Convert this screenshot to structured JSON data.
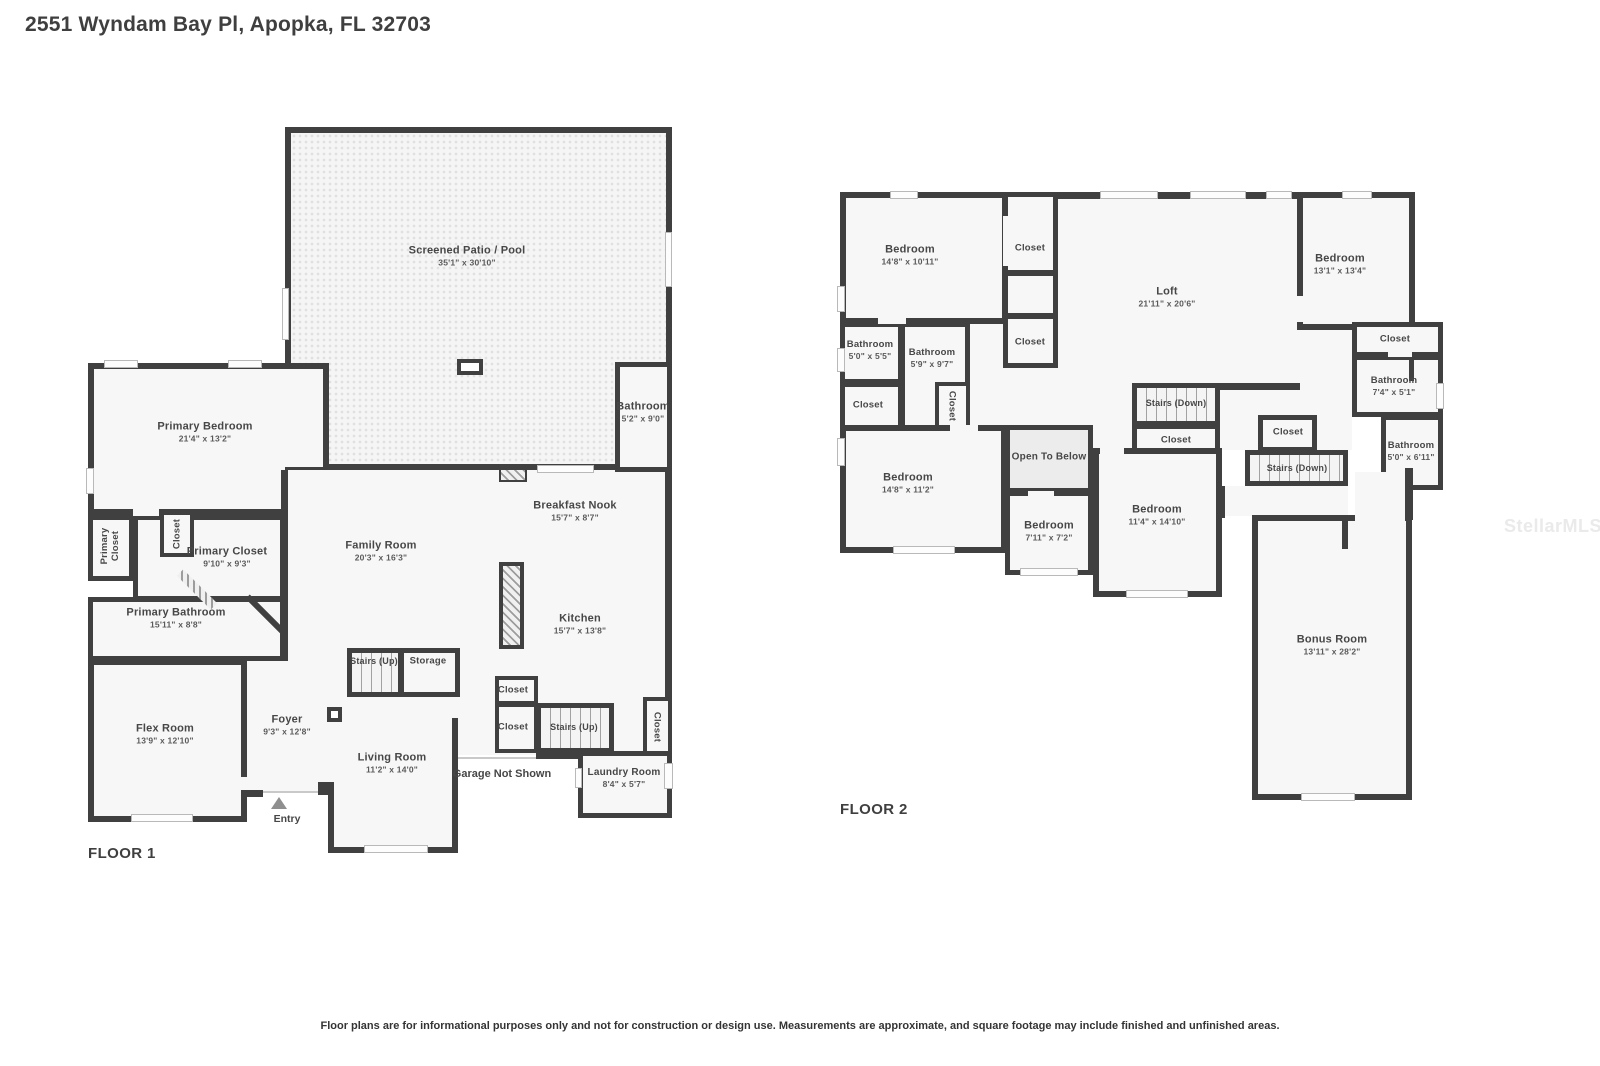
{
  "title": "2551 Wyndam Bay Pl, Apopka, FL 32703",
  "watermark": "StellarMLS",
  "footer": "Floor plans are for informational purposes only and not for construction or design use. Measurements are approximate, and square footage may include finished and unfinished areas.",
  "floor1": {
    "label": "FLOOR 1",
    "entry": "Entry",
    "garage_note": "Garage Not Shown",
    "rooms": {
      "patio": {
        "name": "Screened Patio / Pool",
        "dims": "35'1\" x 30'10\""
      },
      "bathroom": {
        "name": "Bathroom",
        "dims": "5'2\" x 9'0\""
      },
      "primary_bedroom": {
        "name": "Primary Bedroom",
        "dims": "21'4\" x 13'2\""
      },
      "breakfast_nook": {
        "name": "Breakfast Nook",
        "dims": "15'7\" x 8'7\""
      },
      "family_room": {
        "name": "Family Room",
        "dims": "20'3\" x 16'3\""
      },
      "kitchen": {
        "name": "Kitchen",
        "dims": "15'7\" x 13'8\""
      },
      "primary_closet_hall": {
        "name": "Primary Closet"
      },
      "closet_hall": {
        "name": "Closet"
      },
      "primary_closet": {
        "name": "Primary Closet",
        "dims": "9'10\" x 9'3\""
      },
      "primary_bathroom": {
        "name": "Primary Bathroom",
        "dims": "15'11\" x 8'8\""
      },
      "flex_room": {
        "name": "Flex Room",
        "dims": "13'9\" x 12'10\""
      },
      "foyer": {
        "name": "Foyer",
        "dims": "9'3\" x 12'8\""
      },
      "stairs_up_main": {
        "name": "Stairs (Up)"
      },
      "storage": {
        "name": "Storage"
      },
      "living_room": {
        "name": "Living Room",
        "dims": "11'2\" x 14'0\""
      },
      "closet_upper": {
        "name": "Closet"
      },
      "closet_lower": {
        "name": "Closet"
      },
      "stairs_up_side": {
        "name": "Stairs (Up)"
      },
      "closet_side": {
        "name": "Closet"
      },
      "laundry": {
        "name": "Laundry Room",
        "dims": "8'4\" x 5'7\""
      }
    }
  },
  "floor2": {
    "label": "FLOOR 2",
    "rooms": {
      "bedroom_nw": {
        "name": "Bedroom",
        "dims": "14'8\" x 10'11\""
      },
      "closet_n1": {
        "name": "Closet"
      },
      "closet_n2": {
        "name": "Closet"
      },
      "loft": {
        "name": "Loft",
        "dims": "21'11\" x 20'6\""
      },
      "bedroom_ne": {
        "name": "Bedroom",
        "dims": "13'1\" x 13'4\""
      },
      "bathroom_w1": {
        "name": "Bathroom",
        "dims": "5'0\" x 5'5\""
      },
      "bathroom_w2": {
        "name": "Bathroom",
        "dims": "5'9\" x 9'7\""
      },
      "closet_w": {
        "name": "Closet"
      },
      "closet_w2": {
        "name": "Closet"
      },
      "stairs_down_main": {
        "name": "Stairs (Down)"
      },
      "closet_mid": {
        "name": "Closet"
      },
      "closet_e": {
        "name": "Closet"
      },
      "bathroom_e1": {
        "name": "Bathroom",
        "dims": "7'4\" x 5'1\""
      },
      "closet_stairs": {
        "name": "Closet"
      },
      "stairs_down_side": {
        "name": "Stairs (Down)"
      },
      "bathroom_e2": {
        "name": "Bathroom",
        "dims": "5'0\" x 6'11\""
      },
      "open_to_below": {
        "name": "Open To Below"
      },
      "bedroom_sw": {
        "name": "Bedroom",
        "dims": "14'8\" x 11'2\""
      },
      "bedroom_s": {
        "name": "Bedroom",
        "dims": "7'11\" x 7'2\""
      },
      "bedroom_se": {
        "name": "Bedroom",
        "dims": "11'4\" x 14'10\""
      },
      "bonus": {
        "name": "Bonus Room",
        "dims": "13'11\" x 28'2\""
      }
    }
  }
}
